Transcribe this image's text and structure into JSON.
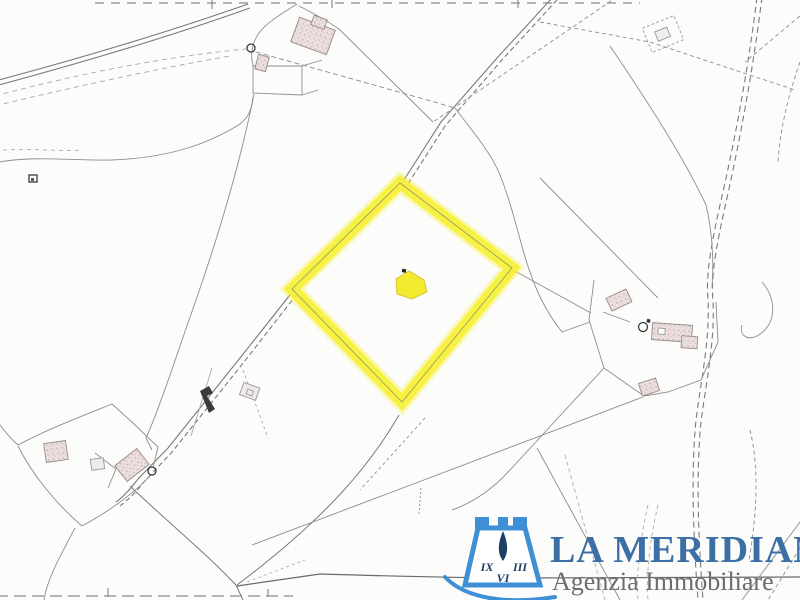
{
  "logo": {
    "brand": "LA MERIDIANA",
    "tagline": "Agenzia Immobiliare",
    "dial_numeral_left": "IX",
    "dial_numeral_right": "III",
    "dial_numeral_bottom": "VI",
    "colors": {
      "icon_blue": "#3f8fd6",
      "icon_navy": "#1d3f66",
      "brand_blue": "#3c6fa5",
      "tagline_gray": "#6d6d6d"
    }
  },
  "map": {
    "background": "#fcfcfa",
    "line_gray": "#8d8d8d",
    "line_light": "#a8a8a8",
    "line_dark": "#3a3a3a",
    "building_outline": "#968a8a",
    "highlight_yellow": "#f6ef35",
    "parcel_building_yellow": "#f3e92e"
  }
}
